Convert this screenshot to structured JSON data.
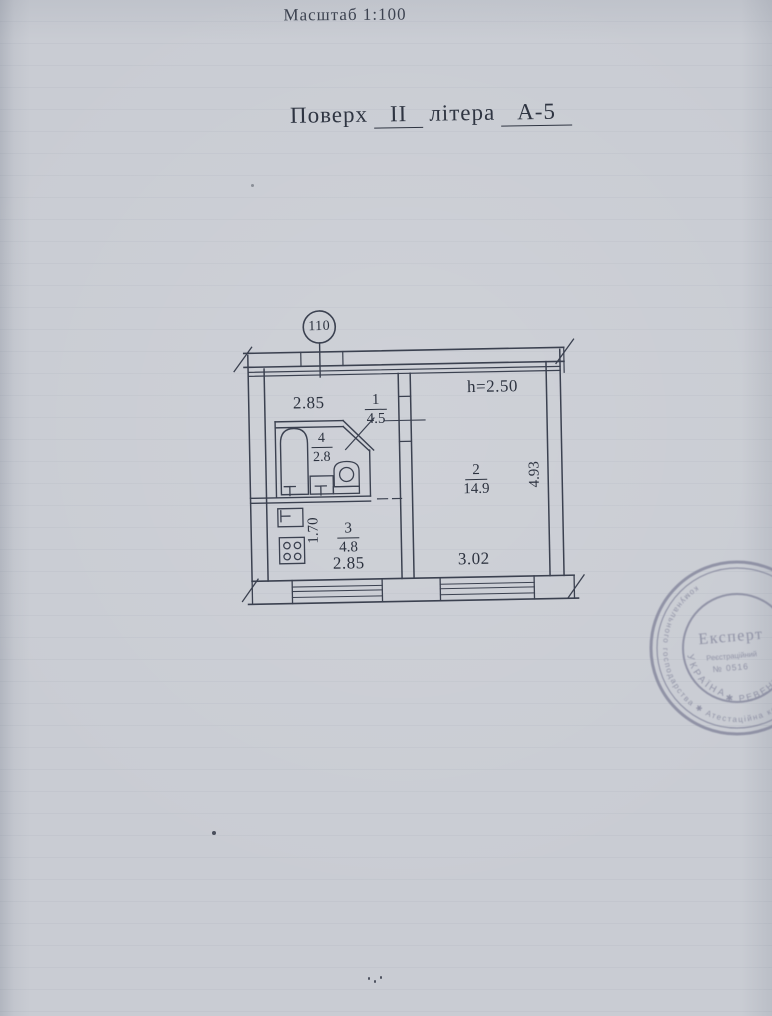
{
  "page": {
    "scale_label": "Масштаб 1:100"
  },
  "title": {
    "prefix": "Поверх",
    "floor": "II",
    "middle": "літера",
    "letter": "А-5"
  },
  "plan": {
    "apartment_number": "110",
    "ceiling_height": "h=2.50",
    "rooms": [
      {
        "number": "1",
        "area": "4.5"
      },
      {
        "number": "2",
        "area": "14.9"
      },
      {
        "number": "3",
        "area": "4.8"
      },
      {
        "number": "4",
        "area": "2.8"
      }
    ],
    "dims": {
      "hall_width": "2.85",
      "kitchen_width": "2.85",
      "kitchen_depth": "1.70",
      "room2_width": "3.02",
      "room2_depth": "4.93"
    }
  },
  "stamp": {
    "center_title": "Експерт",
    "reg_label": "Реєстраційний",
    "reg_number": "№ 0516",
    "ring_top": "УКРАЇНА",
    "ring_outer": "комунального господарства ✱ Атестаційна комісія ✱",
    "ring_bottom": "✱ РЕВЕНКО ✱",
    "ink_color": "#84869c"
  },
  "colors": {
    "paper": "#c9ccd3",
    "ink": "#353b48"
  }
}
